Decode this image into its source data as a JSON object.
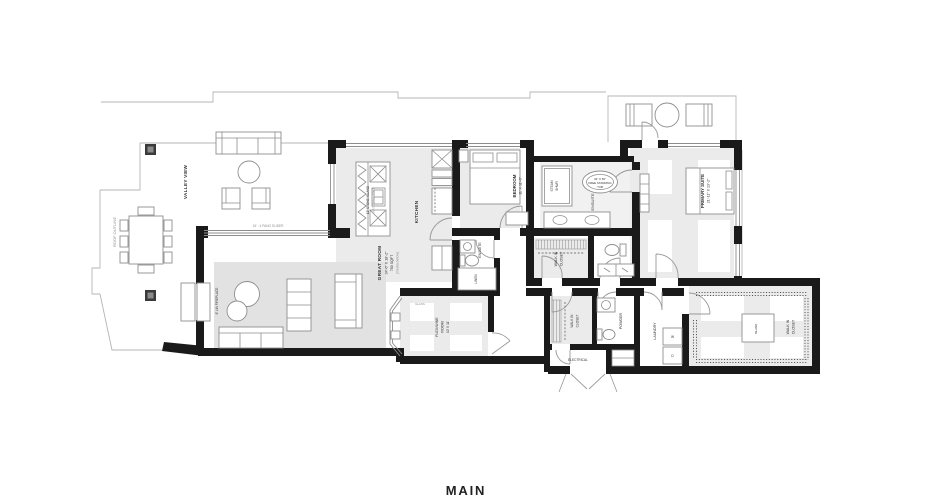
{
  "title": "MAIN",
  "palette": {
    "wall": "#1a1a1a",
    "floor": "#ebebeb",
    "rug": "#e2e2e2",
    "ink": "#333333"
  },
  "site": {
    "valley_view": "VALLEY VIEW",
    "roof_outline": "ROOF OUTLINE",
    "pano_slider": "16' - 4 PANO SLIDER"
  },
  "rooms": {
    "great_room": {
      "name": "GREAT ROOM",
      "dims": "34'-6\" X 18'-2\"",
      "area": "780 SQFT",
      "note": "(media below)"
    },
    "fireplace": {
      "name": "6' LIN FIREPLACE"
    },
    "kitchen": {
      "name": "KITCHEN"
    },
    "island": {
      "name": "12' STONE ISLAND",
      "note": "WATERFALL EDGE"
    },
    "bedroom": {
      "name": "BEDROOM",
      "dims": "11' X 11'-6\""
    },
    "bedroom_ensuite": {
      "name": "ENSUITE"
    },
    "linen": {
      "name": "LINEN"
    },
    "primary_suite": {
      "name": "PRIMARY SUITE",
      "dims": "21'-11\" X 13'-2\""
    },
    "primary_ensuite": {
      "name": "ENSUITE"
    },
    "steam_shower": {
      "name": "STEAM",
      "name2": "SHWR"
    },
    "tub": {
      "line1": "34\" X 66\"",
      "line2": "FREE STANDING",
      "line3": "TUB"
    },
    "walkin_primary": {
      "name": "WALK IN",
      "name2": "CLOSET"
    },
    "flex": {
      "name": "FLEX/WINE",
      "name2": "ROOM",
      "dims": "10' X 11'"
    },
    "glass": {
      "name": "GLASS"
    },
    "walkin_hall": {
      "name": "WALK IN",
      "name2": "CLOSET"
    },
    "powder": {
      "name": "POWDER"
    },
    "laundry": {
      "name": "LAUNDRY"
    },
    "electrical": {
      "name": "ELECTRICAL"
    },
    "walkin_main": {
      "name": "WALK IN",
      "name2": "CLOSET",
      "island": "ISLAND"
    },
    "washer": "W",
    "dryer": "D"
  }
}
